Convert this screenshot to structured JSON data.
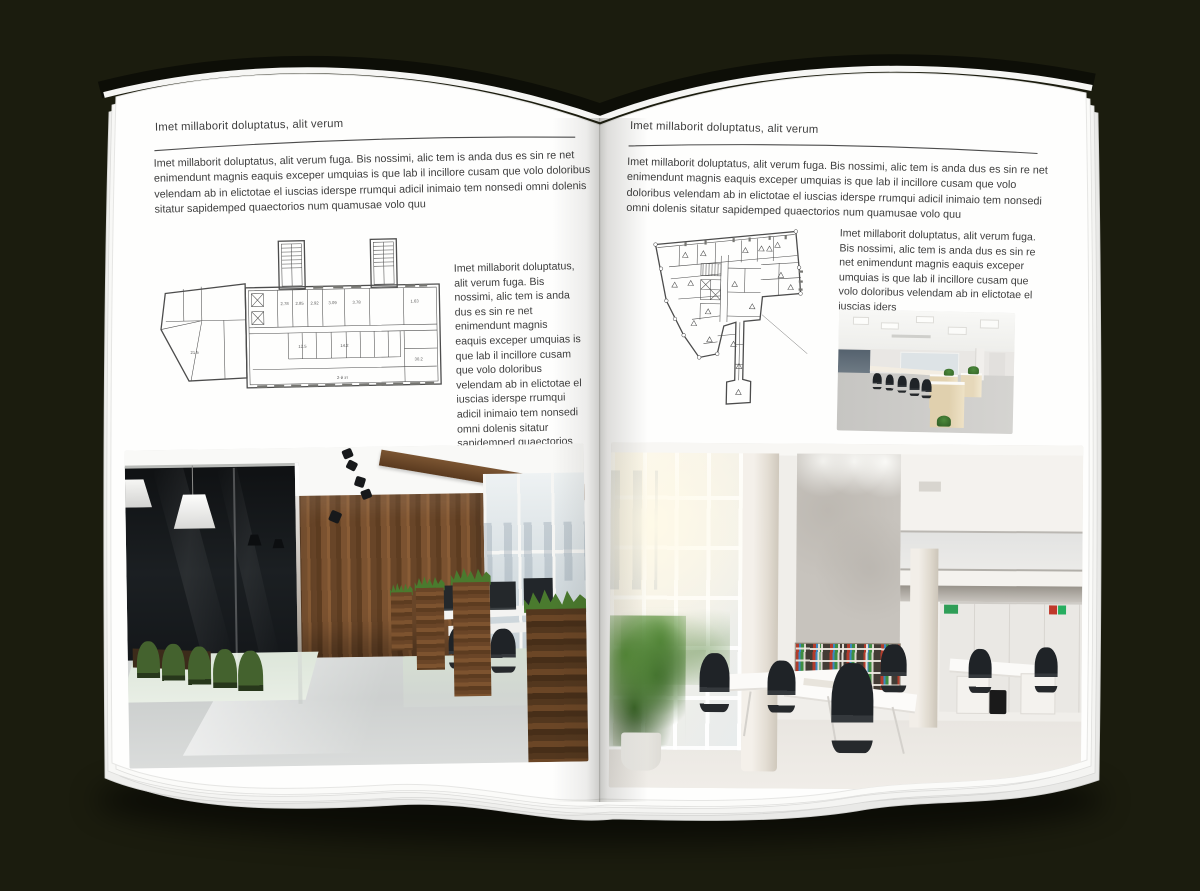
{
  "colors": {
    "background": "#1b1c0e",
    "page": "#ffffff",
    "text": "#3e3e3e",
    "rule": "#4d4d4d",
    "plan_stroke": "#4c4c4c",
    "photo_left_wood": "#7a5130",
    "photo_left_chair_green": "#44622e",
    "photo_right_binder_red": "#b23c2c",
    "photo_right_binder_green": "#3e8e41",
    "photo_right_binder_blue": "#3c87c0",
    "photo_small_desk_wood": "#e2d2b0"
  },
  "left_page": {
    "header": "Imet millaborit doluptatus, alit verum",
    "intro": "Imet millaborit doluptatus, alit verum fuga. Bis nossimi, alic tem is anda dus es sin re net enimendunt magnis eaquis exceper umquias is que lab il incillore cusam que volo doloribus velendam ab in elictotae el iuscias iderspe rrumqui adicil inimaio tem nonsedi omni dolenis sitatur sapidemped quaectorios num quamusae volo quu",
    "side_text": "Imet millaborit doluptatus, alit verum fuga. Bis nossimi, alic tem is anda dus es sin re net enimendunt magnis eaquis exceper umquias is que lab il incillore cusam que volo doloribus velendam ab in elictotae el iuscias iderspe rrumqui adicil inimaio tem nonsedi omni dolenis sitatur sapidemped quaectorios num quamusae volo quu",
    "plan_labels": [
      "2.78",
      "2.85",
      "2.92",
      "3.09",
      "3.78",
      "1.63",
      "12.5",
      "14.2",
      "21.5",
      "30.2",
      "2-й эт"
    ]
  },
  "right_page": {
    "header": "Imet millaborit doluptatus, alit verum",
    "intro": "Imet millaborit doluptatus, alit verum fuga. Bis nossimi, alic tem is anda dus es sin re net enimendunt magnis eaquis exceper umquias is que lab il incillore cusam que volo doloribus velendam ab in elictotae el iuscias iderspe rrumqui adicil inimaio tem nonsedi omni dolenis sitatur sapidemped quaectorios num quamusae volo quu",
    "side_text": "Imet millaborit doluptatus, alit verum fuga. Bis nossimi, alic tem is anda dus es sin re net enimendunt magnis eaquis exceper umquias is que lab il incillore cusam que volo doloribus velendam ab in elictotae el iuscias iders"
  }
}
